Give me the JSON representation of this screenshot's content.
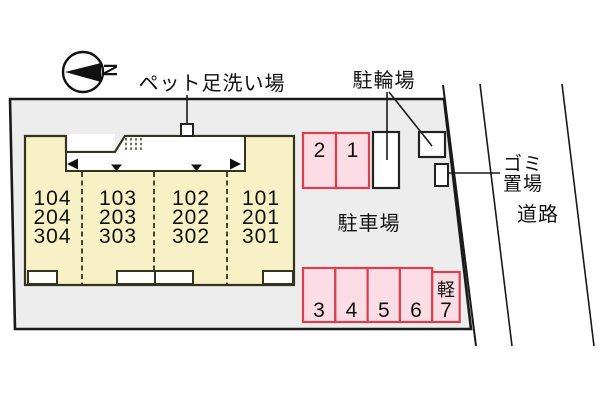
{
  "diagram": {
    "compass_letter": "N",
    "labels": {
      "pet_wash": "ペット足洗い場",
      "bicycle_parking": "駐輪場",
      "garbage_line1": "ゴミ",
      "garbage_line2": "置場",
      "road": "道路",
      "car_parking": "駐車場"
    },
    "building": {
      "units": [
        {
          "rooms": [
            "104",
            "204",
            "304"
          ]
        },
        {
          "rooms": [
            "103",
            "203",
            "303"
          ]
        },
        {
          "rooms": [
            "102",
            "202",
            "302"
          ]
        },
        {
          "rooms": [
            "101",
            "201",
            "301"
          ]
        }
      ]
    },
    "stalls": {
      "top": [
        "2",
        "1"
      ],
      "bottom": [
        "3",
        "4",
        "5",
        "6"
      ],
      "kei_label": "軽",
      "kei_number": "7"
    },
    "colors": {
      "site_fill": "#ededed",
      "building_fill": "#f8f1c6",
      "stall_fill": "#fcdce5",
      "stall_stroke": "#d8404e",
      "line": "#1a1a1a"
    }
  }
}
